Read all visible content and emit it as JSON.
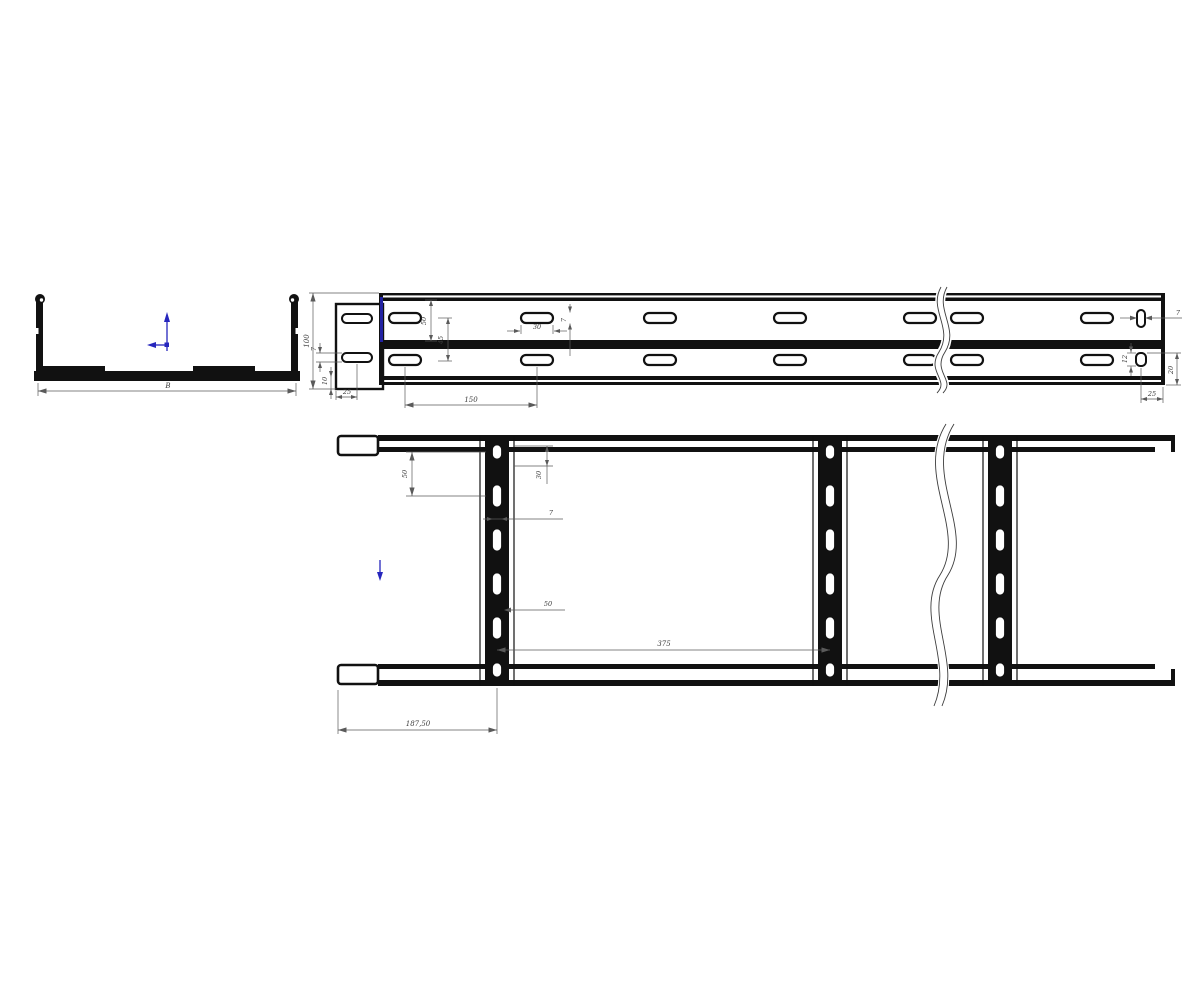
{
  "page": {
    "background": "#ffffff"
  },
  "drawing": {
    "type": "cable-ladder-technical-drawing",
    "colors": {
      "line": "#111111",
      "dimension": "#5a5a5a",
      "text": "#3a3a3a",
      "accent_blue": "#2626bd"
    },
    "views": {
      "section": {
        "label_width": "B"
      },
      "side": {
        "height": "100",
        "slot_height": "7",
        "bottom_offset": "10",
        "end_to_slot": "25",
        "slot_pitch": "150",
        "flange_gap": "50",
        "web_gap": "45",
        "slot_length": "30",
        "mid_slot_height": "7",
        "end_slot_width": "7",
        "end_slot_height": "12",
        "end_vertical": "20",
        "end_horizontal": "25"
      },
      "plan": {
        "rung_slot_pitch": "50",
        "edge_to_slot": "30",
        "rung_slot_width": "7",
        "slot_dim": "50",
        "rung_pitch": "375",
        "end_to_first_rung": "187,50"
      }
    },
    "icons": {
      "axis": "coordinate-axis",
      "direction": "down-arrow"
    }
  }
}
